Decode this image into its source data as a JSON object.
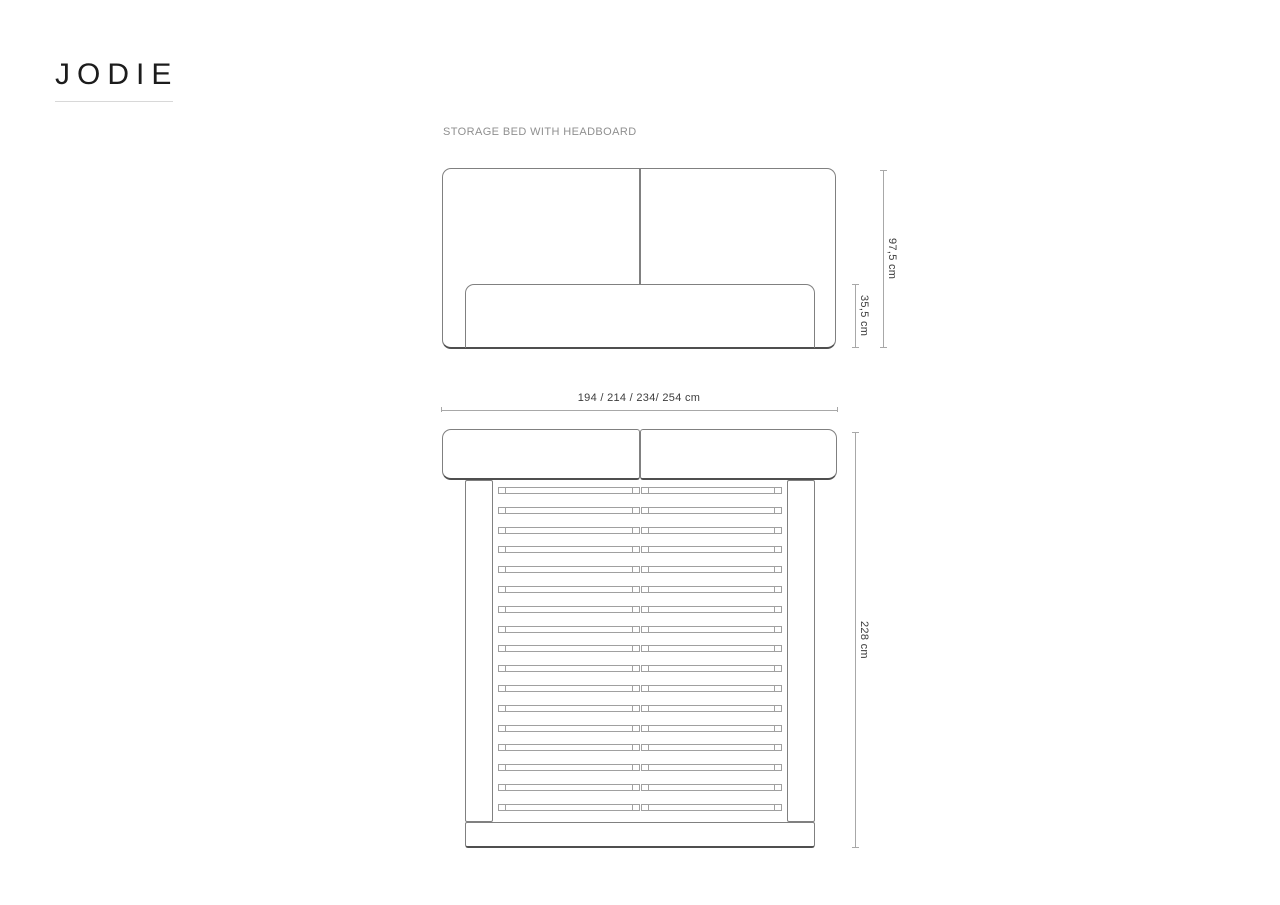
{
  "brand": {
    "name": "JODIE"
  },
  "product": {
    "label": "STORAGE BED WITH HEADBOARD"
  },
  "dimensions": {
    "headboard_height": "97,5 cm",
    "frame_height": "35,5 cm",
    "width_options": "194 / 214 / 234/ 254 cm",
    "length": "228 cm"
  },
  "top_view": {
    "slat_rows": 17
  },
  "colors": {
    "line": "#808080",
    "line_dark": "#4f4f4f",
    "slat_line": "#a0a0a0",
    "dim_line": "#a8a8a8",
    "text_dark": "#3d3d3d",
    "text_gray": "#8f8f8f",
    "logo": "#1c1c1c"
  }
}
